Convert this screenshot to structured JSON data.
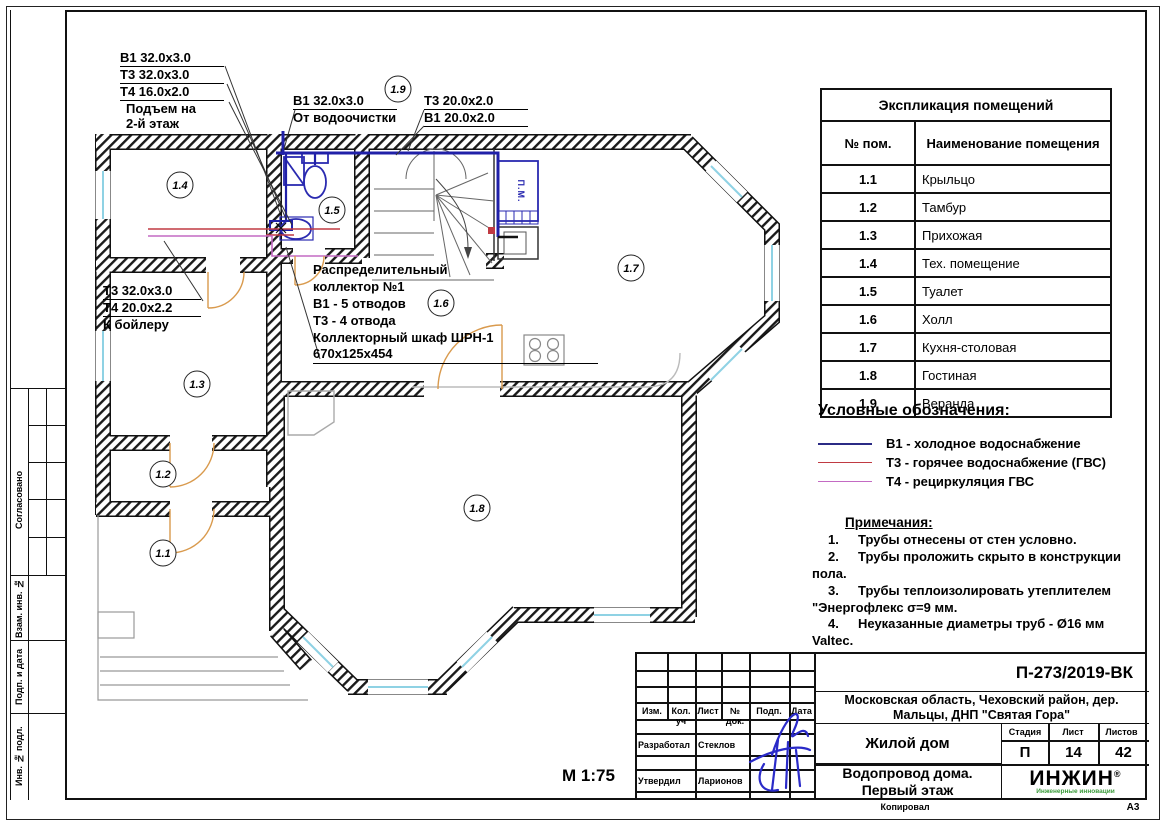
{
  "sheet": {
    "scale": "М 1:75",
    "format": "А3",
    "copied": "Копировал"
  },
  "side_column": {
    "labels": [
      "Согласовано",
      "Взам. инв. №",
      "Подп. и дата",
      "Инв. № подл."
    ]
  },
  "plan": {
    "badges": [
      "1.1",
      "1.2",
      "1.3",
      "1.4",
      "1.5",
      "1.6",
      "1.7",
      "1.8",
      "1.9"
    ],
    "pm_label": "П.М.",
    "annotations": {
      "riser": {
        "lines": [
          "В1 32.0х3.0",
          "Т3 32.0х3.0",
          "Т4 16.0х2.0"
        ],
        "note1": "Подъем на",
        "note2": "2-й этаж"
      },
      "inlet": {
        "line": "В1 32.0х3.0",
        "note": "От водоочистки"
      },
      "kitchen": {
        "lines": [
          "Т3 20.0х2.0",
          "В1 20.0х2.0"
        ]
      },
      "boiler": {
        "lines": [
          "Т3 32.0х3.0",
          "Т4 20.0х2.2"
        ],
        "note": "К бойлеру"
      },
      "collector": {
        "lines": [
          "Распределительный",
          "коллектор №1",
          "В1 - 5 отводов",
          "Т3 - 4 отвода",
          "Коллекторный шкаф ШРН-1",
          "670х125х454"
        ]
      }
    }
  },
  "room_table": {
    "title": "Экспликация помещений",
    "col_num": "№ пом.",
    "col_name": "Наименование помещения",
    "rows": [
      {
        "num": "1.1",
        "name": "Крыльцо"
      },
      {
        "num": "1.2",
        "name": "Тамбур"
      },
      {
        "num": "1.3",
        "name": "Прихожая"
      },
      {
        "num": "1.4",
        "name": "Тех. помещение"
      },
      {
        "num": "1.5",
        "name": "Туалет"
      },
      {
        "num": "1.6",
        "name": "Холл"
      },
      {
        "num": "1.7",
        "name": "Кухня-столовая"
      },
      {
        "num": "1.8",
        "name": "Гостиная"
      },
      {
        "num": "1.9",
        "name": "Веранда"
      }
    ]
  },
  "legend": {
    "title": "Условные обозначения:",
    "items": [
      {
        "label": "В1 - холодное водоснабжение",
        "color": "#2b2b85"
      },
      {
        "label": "Т3 - горячее водоснабжение (ГВС)",
        "color": "#c03a42"
      },
      {
        "label": "Т4 - рециркуляция ГВС",
        "color": "#c36ac3"
      }
    ]
  },
  "notes": {
    "title": "Примечания:",
    "items": [
      {
        "n": "1.",
        "text": "Трубы отнесены от стен условно."
      },
      {
        "n": "2.",
        "text": "Трубы проложить скрыто в конструкции пола."
      },
      {
        "n": "3.",
        "text": "Трубы теплоизолировать утеплителем \"Энергофлекс σ=9 мм."
      },
      {
        "n": "4.",
        "text": "Неуказанные диаметры труб - Ø16 мм Valtec."
      }
    ]
  },
  "title_block": {
    "doc_number": "П-273/2019-ВК",
    "address_line1": "Московская область, Чеховский район, дер.",
    "address_line2": "Мальцы, ДНП \"Святая Гора\"",
    "object_name": "Жилой дом",
    "stage_label": "Стадия",
    "sheet_label": "Лист",
    "sheets_label": "Листов",
    "stage": "П",
    "sheet": "14",
    "sheets": "42",
    "drawing_title_line1": "Водопровод дома.",
    "drawing_title_line2": "Первый этаж",
    "header_cols": [
      "Изм.",
      "Кол. уч",
      "Лист",
      "№ док.",
      "Подп.",
      "Дата"
    ],
    "developed_label": "Разработал",
    "developed_name": "Стеклов",
    "approved_label": "Утвердил",
    "approved_name": "Ларионов",
    "logo": "ИНЖИН",
    "logo_reg": "®",
    "logo_sub": "Инженерные инновации"
  }
}
